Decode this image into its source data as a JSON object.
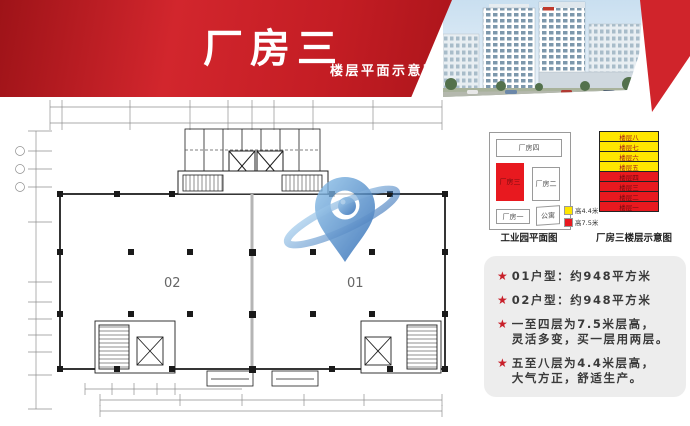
{
  "banner": {
    "title": "厂房三",
    "subtitle": "楼层平面示意图"
  },
  "plan": {
    "unit_left": "02",
    "unit_right": "01"
  },
  "park_map": {
    "caption": "工业园平面图",
    "b4": "厂房四",
    "b3": "厂房三",
    "b2": "厂房二",
    "b1": "厂房一",
    "apt": "公寓",
    "highlight_color": "#e8191f"
  },
  "floor_stack": {
    "caption": "厂房三楼层示意图",
    "floors": [
      {
        "label": "楼层八",
        "tier": "upper"
      },
      {
        "label": "楼层七",
        "tier": "upper"
      },
      {
        "label": "楼层六",
        "tier": "upper"
      },
      {
        "label": "楼层五",
        "tier": "upper"
      },
      {
        "label": "楼层四",
        "tier": "lower"
      },
      {
        "label": "楼层三",
        "tier": "lower"
      },
      {
        "label": "楼层二",
        "tier": "lower"
      },
      {
        "label": "楼层一",
        "tier": "lower"
      }
    ],
    "legend": [
      {
        "label": "高4.4米",
        "color": "#ffe600"
      },
      {
        "label": "高7.5米",
        "color": "#e8191f"
      }
    ]
  },
  "highlights": {
    "star": "★",
    "items": [
      {
        "lines": [
          "01户型：约948平方米"
        ]
      },
      {
        "lines": [
          "02户型：约948平方米"
        ]
      },
      {
        "lines": [
          "一至四层为7.5米层高，",
          "灵活多变，买一层用两层。"
        ]
      },
      {
        "lines": [
          "五至八层为4.4米层高，",
          "大气方正，舒适生产。"
        ]
      }
    ]
  },
  "colors": {
    "accent_red": "#d0242b",
    "stack_yellow": "#ffe600",
    "stack_red": "#e8191f",
    "watermark_blue": "#2e6eb5"
  }
}
